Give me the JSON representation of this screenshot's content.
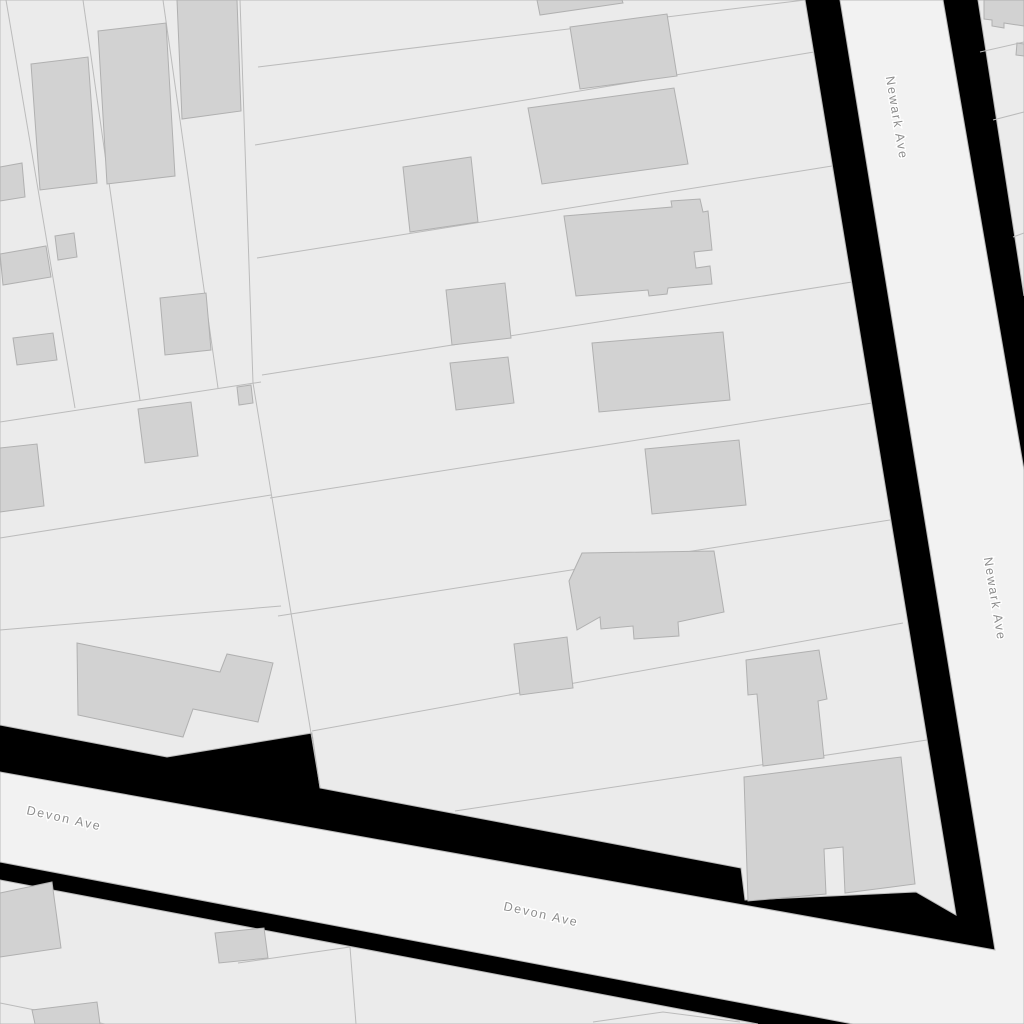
{
  "map": {
    "kind": "parcel-basemap",
    "streets": [
      {
        "id": "newark",
        "label": "Newark Ave",
        "orientation": "vertical-diagonal",
        "labels_shown": 2
      },
      {
        "id": "devon",
        "label": "Devon Ave",
        "orientation": "horizontal-diagonal",
        "labels_shown": 2
      }
    ],
    "colors": {
      "background": "#000000",
      "parcel": "#ebebeb",
      "road_fill": "#f2f2f2",
      "boundary_line": "#bbbbbb",
      "building_fill": "#d2d2d2",
      "building_stroke": "#b0b0b0",
      "label_text": "#8d8d8d",
      "label_halo": "#ffffff"
    }
  }
}
